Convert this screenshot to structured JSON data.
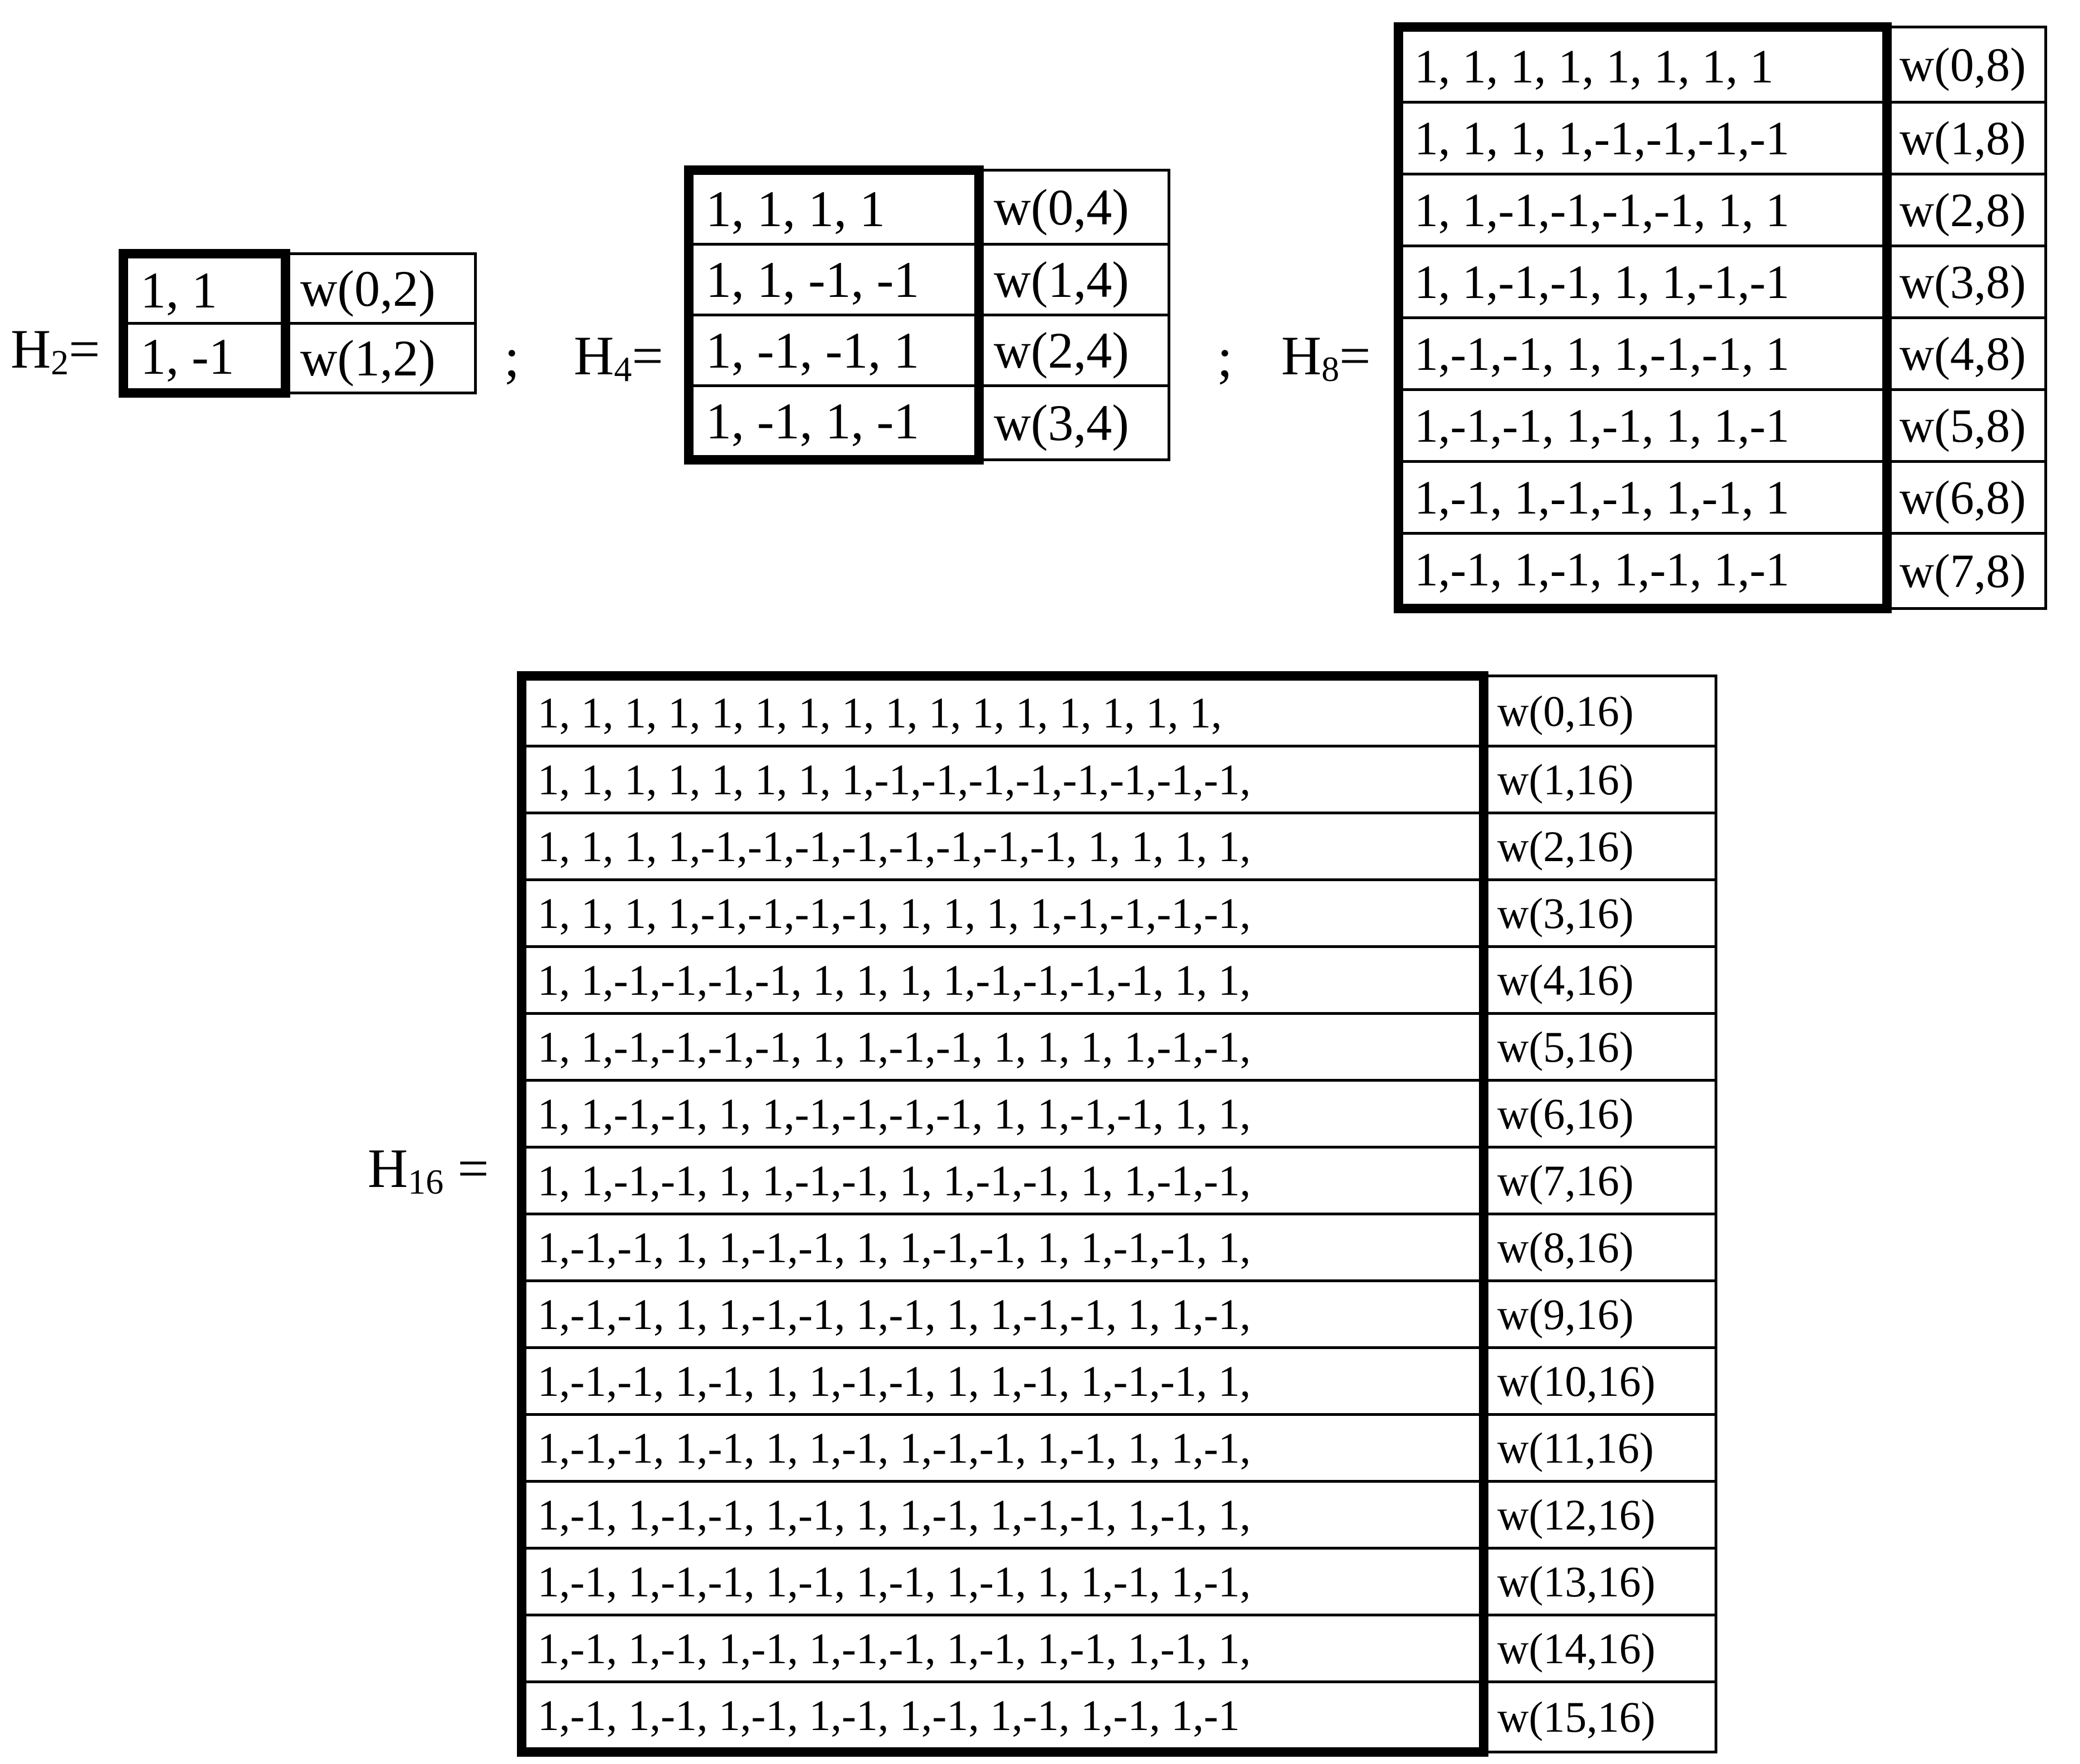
{
  "figure": {
    "description_labels": {
      "sep_after_h2": ";",
      "sep_after_h4": ";"
    }
  },
  "matrices": [
    {
      "id": "H2",
      "label": {
        "base": "H",
        "sub": "2",
        "eq": "="
      },
      "rows": [
        "1, 1",
        "1, -1"
      ],
      "w_labels": [
        "w(0,2)",
        "w(1,2)"
      ]
    },
    {
      "id": "H4",
      "label": {
        "base": "H",
        "sub": "4",
        "eq": "="
      },
      "rows": [
        "1, 1, 1, 1",
        "1, 1, -1, -1",
        "1, -1, -1, 1",
        "1, -1, 1, -1"
      ],
      "w_labels": [
        "w(0,4)",
        "w(1,4)",
        "w(2,4)",
        "w(3,4)"
      ]
    },
    {
      "id": "H8",
      "label": {
        "base": "H",
        "sub": "8",
        "eq": "="
      },
      "rows": [
        "1, 1, 1, 1, 1, 1, 1, 1",
        "1, 1, 1, 1,-1,-1,-1,-1",
        "1, 1,-1,-1,-1,-1, 1, 1",
        "1, 1,-1,-1, 1, 1,-1,-1",
        "1,-1,-1, 1, 1,-1,-1, 1",
        "1,-1,-1, 1,-1, 1, 1,-1",
        "1,-1, 1,-1,-1, 1,-1, 1",
        "1,-1, 1,-1, 1,-1, 1,-1"
      ],
      "w_labels": [
        "w(0,8)",
        "w(1,8)",
        "w(2,8)",
        "w(3,8)",
        "w(4,8)",
        "w(5,8)",
        "w(6,8)",
        "w(7,8)"
      ]
    },
    {
      "id": "H16",
      "label": {
        "base": "H",
        "sub": "16",
        "eq": " ="
      },
      "rows": [
        "1, 1, 1, 1, 1, 1, 1, 1, 1, 1, 1, 1, 1, 1, 1, 1,",
        "1, 1, 1, 1, 1, 1, 1, 1,-1,-1,-1,-1,-1,-1,-1,-1,",
        "1, 1, 1, 1,-1,-1,-1,-1,-1,-1,-1,-1, 1, 1, 1, 1,",
        "1, 1, 1, 1,-1,-1,-1,-1, 1, 1, 1, 1,-1,-1,-1,-1,",
        "1, 1,-1,-1,-1,-1, 1, 1, 1, 1,-1,-1,-1,-1, 1, 1,",
        "1, 1,-1,-1,-1,-1, 1, 1,-1,-1, 1, 1, 1, 1,-1,-1,",
        "1, 1,-1,-1, 1, 1,-1,-1,-1,-1, 1, 1,-1,-1, 1, 1,",
        "1, 1,-1,-1, 1, 1,-1,-1, 1, 1,-1,-1, 1, 1,-1,-1,",
        "1,-1,-1, 1, 1,-1,-1, 1, 1,-1,-1, 1, 1,-1,-1, 1,",
        "1,-1,-1, 1, 1,-1,-1, 1,-1, 1, 1,-1,-1, 1, 1,-1,",
        "1,-1,-1, 1,-1, 1, 1,-1,-1, 1, 1,-1, 1,-1,-1, 1,",
        "1,-1,-1, 1,-1, 1, 1,-1, 1,-1,-1, 1,-1, 1, 1,-1,",
        "1,-1, 1,-1,-1, 1,-1, 1, 1,-1, 1,-1,-1, 1,-1, 1,",
        "1,-1, 1,-1,-1, 1,-1, 1,-1, 1,-1, 1, 1,-1, 1,-1,",
        "1,-1, 1,-1, 1,-1, 1,-1,-1, 1,-1, 1,-1, 1,-1, 1,",
        "1,-1, 1,-1, 1,-1, 1,-1, 1,-1, 1,-1, 1,-1, 1,-1"
      ],
      "w_labels": [
        "w(0,16)",
        "w(1,16)",
        "w(2,16)",
        "w(3,16)",
        "w(4,16)",
        "w(5,16)",
        "w(6,16)",
        "w(7,16)",
        "w(8,16)",
        "w(9,16)",
        "w(10,16)",
        "w(11,16)",
        "w(12,16)",
        "w(13,16)",
        "w(14,16)",
        "w(15,16)"
      ]
    }
  ]
}
